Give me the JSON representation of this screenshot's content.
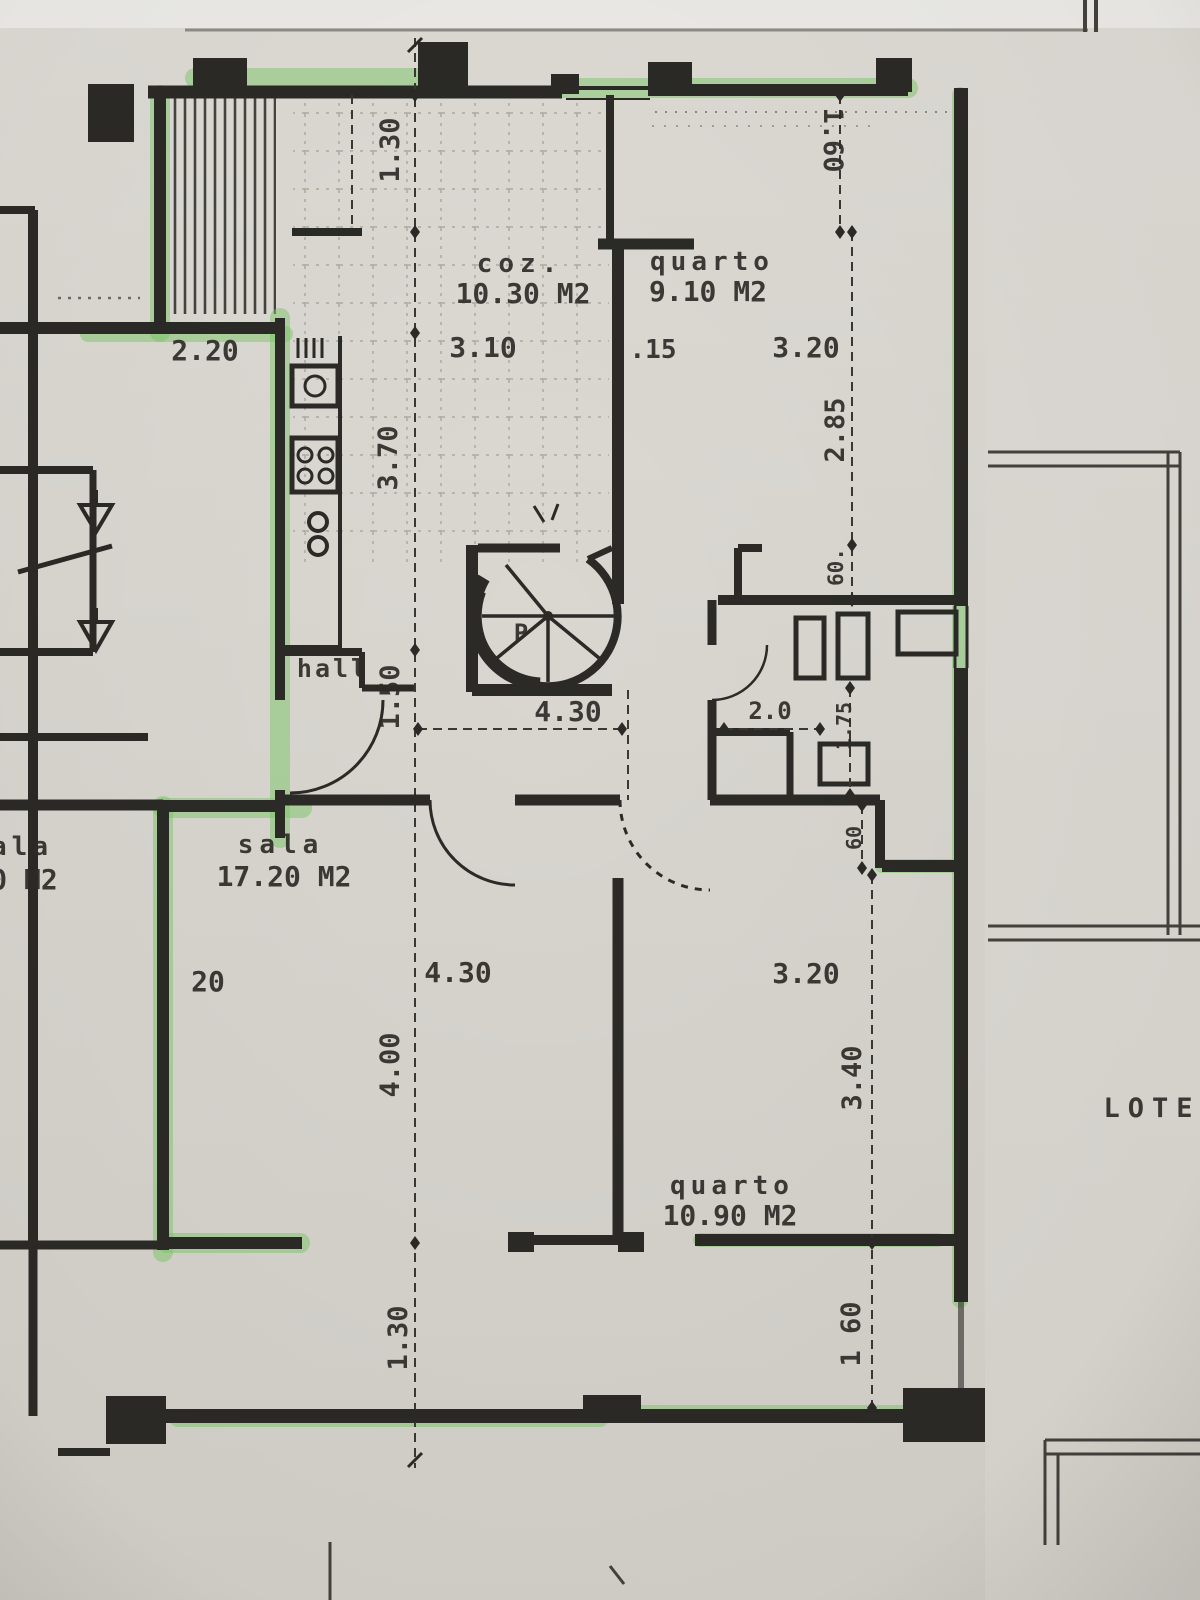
{
  "title": "highlighted floor plan photo",
  "palette": {
    "paper": "#d8d5cf",
    "paper_edge": "#ecebe7",
    "ink": "#2b2a27",
    "highlight_green": "#7cc868",
    "dim_line": "#3a3833"
  },
  "rooms": [
    {
      "name": "cozinha",
      "label": "coz.",
      "area": "10.30 M2"
    },
    {
      "name": "quarto-top",
      "label": "quarto",
      "area": "9.10 M2"
    },
    {
      "name": "hall",
      "label": "hall",
      "area": ""
    },
    {
      "name": "sala",
      "label": "sala",
      "area": "17.20 M2"
    },
    {
      "name": "sala-left-partial",
      "label": "ala",
      "area": "0 M2"
    },
    {
      "name": "quarto-bottom",
      "label": "quarto",
      "area": "10.90 M2"
    }
  ],
  "labels": [
    {
      "name": "room-label-cozinha",
      "text": "coz.",
      "x": 520,
      "y": 272,
      "size": 26,
      "spacing": 6
    },
    {
      "name": "room-area-cozinha",
      "text": "10.30 M2",
      "x": 523,
      "y": 303,
      "size": 28
    },
    {
      "name": "room-label-quarto-top",
      "text": "quarto",
      "x": 712,
      "y": 270,
      "size": 26,
      "spacing": 5
    },
    {
      "name": "room-area-quarto-top",
      "text": "9.10 M2",
      "x": 708,
      "y": 301,
      "size": 28
    },
    {
      "name": "room-label-hall",
      "text": "hall",
      "x": 333,
      "y": 677,
      "size": 25,
      "spacing": 3
    },
    {
      "name": "room-label-sala",
      "text": "sala",
      "x": 281,
      "y": 853,
      "size": 26,
      "spacing": 6
    },
    {
      "name": "room-area-sala",
      "text": "17.20 M2",
      "x": 284,
      "y": 886,
      "size": 28
    },
    {
      "name": "room-label-sala-partial",
      "text": "ala",
      "x": 22,
      "y": 855,
      "size": 26,
      "spacing": 5
    },
    {
      "name": "room-area-sala-partial",
      "text": "0 M2",
      "x": 24,
      "y": 889,
      "size": 28
    },
    {
      "name": "room-label-quarto-bottom",
      "text": "quarto",
      "x": 732,
      "y": 1194,
      "size": 26,
      "spacing": 5
    },
    {
      "name": "room-area-quarto-bottom",
      "text": "10.90 M2",
      "x": 730,
      "y": 1225,
      "size": 28
    },
    {
      "name": "stair-label-p",
      "text": "P",
      "x": 521,
      "y": 641,
      "size": 24
    },
    {
      "name": "lot-label",
      "text": "LOTE",
      "x": 1152,
      "y": 1117,
      "size": 27,
      "spacing": 8
    },
    {
      "name": "dim-width-2-20",
      "text": "2.20",
      "x": 205,
      "y": 360,
      "size": 28
    },
    {
      "name": "dim-width-3-10",
      "text": "3.10",
      "x": 483,
      "y": 357,
      "size": 28
    },
    {
      "name": "dim-wall-15",
      "text": ".15",
      "x": 653,
      "y": 358,
      "size": 26
    },
    {
      "name": "dim-width-3-20-top",
      "text": "3.20",
      "x": 806,
      "y": 357,
      "size": 28
    },
    {
      "name": "dim-height-1-30-top",
      "text": "1.30",
      "x": 399,
      "y": 150,
      "size": 27,
      "rot": -90
    },
    {
      "name": "dim-height-1-60-top",
      "text": "1.60",
      "x": 824,
      "y": 140,
      "size": 27,
      "rot": 90
    },
    {
      "name": "dim-height-3-70",
      "text": "3.70",
      "x": 397,
      "y": 458,
      "size": 27,
      "rot": -90
    },
    {
      "name": "dim-height-2-85",
      "text": "2.85",
      "x": 844,
      "y": 430,
      "size": 27,
      "rot": -90
    },
    {
      "name": "dim-height-60-bath",
      "text": "60.",
      "x": 843,
      "y": 567,
      "size": 21,
      "rot": -90
    },
    {
      "name": "dim-height-1-50",
      "text": "1.50",
      "x": 399,
      "y": 697,
      "size": 27,
      "rot": -90
    },
    {
      "name": "dim-width-4-30-mid",
      "text": "4.30",
      "x": 568,
      "y": 721,
      "size": 28
    },
    {
      "name": "dim-width-2-0",
      "text": "2.0",
      "x": 770,
      "y": 719,
      "size": 24
    },
    {
      "name": "dim-height-1-75",
      "text": "1.75",
      "x": 851,
      "y": 726,
      "size": 20,
      "rot": -90
    },
    {
      "name": "dim-height-60-right",
      "text": "60",
      "x": 861,
      "y": 838,
      "size": 20,
      "rot": -90
    },
    {
      "name": "dim-width-20",
      "text": "20",
      "x": 208,
      "y": 991,
      "size": 28
    },
    {
      "name": "dim-width-4-30-sala",
      "text": "4.30",
      "x": 458,
      "y": 982,
      "size": 28
    },
    {
      "name": "dim-width-3-20-bottom",
      "text": "3.20",
      "x": 806,
      "y": 983,
      "size": 28
    },
    {
      "name": "dim-height-4-00",
      "text": "4.00",
      "x": 399,
      "y": 1065,
      "size": 27,
      "rot": -90
    },
    {
      "name": "dim-height-3-40",
      "text": "3.40",
      "x": 861,
      "y": 1078,
      "size": 27,
      "rot": -90
    },
    {
      "name": "dim-height-1-30-bottom",
      "text": "1.30",
      "x": 407,
      "y": 1338,
      "size": 27,
      "rot": -90
    },
    {
      "name": "dim-height-1-60-bottom",
      "text": "1 60",
      "x": 860,
      "y": 1334,
      "size": 27,
      "rot": -90
    }
  ]
}
